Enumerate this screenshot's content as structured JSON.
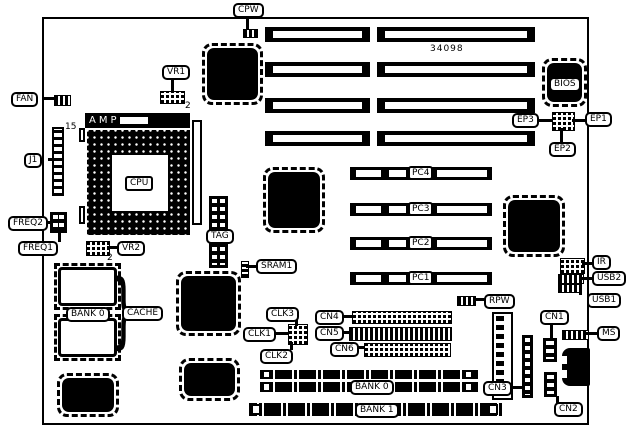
{
  "board": {
    "part_number": "34098",
    "ink": "#000000",
    "paper": "#ffffff"
  },
  "labels": {
    "cpw": "CPW",
    "fan": "FAN",
    "j1": "J1",
    "vr1": "VR1",
    "vr2": "VR2",
    "freq1": "FREQ1",
    "freq2": "FREQ2",
    "amp": "AMP",
    "cpu": "CPU",
    "tag": "TAG",
    "sram1": "SRAM1",
    "cache_bank0": "BANK 0",
    "cache": "CACHE",
    "cache_brace": "}",
    "clk1": "CLK1",
    "clk2": "CLK2",
    "clk3": "CLK3",
    "cn1": "CN1",
    "cn2": "CN2",
    "cn3": "CN3",
    "cn4": "CN4",
    "cn5": "CN5",
    "cn6": "CN6",
    "pc1": "PC1",
    "pc2": "PC2",
    "pc3": "PC3",
    "pc4": "PC4",
    "ep1": "EP1",
    "ep2": "EP2",
    "ep3": "EP3",
    "bios": "BIOS",
    "ir": "IR",
    "usb1": "USB1",
    "usb2": "USB2",
    "ms": "MS",
    "rpw": "RPW",
    "bank0": "BANK 0",
    "bank1": "BANK 1"
  },
  "annotations": {
    "j1_pin15": "15",
    "vr1_pin2": "2",
    "vr2_pin2": "2"
  }
}
